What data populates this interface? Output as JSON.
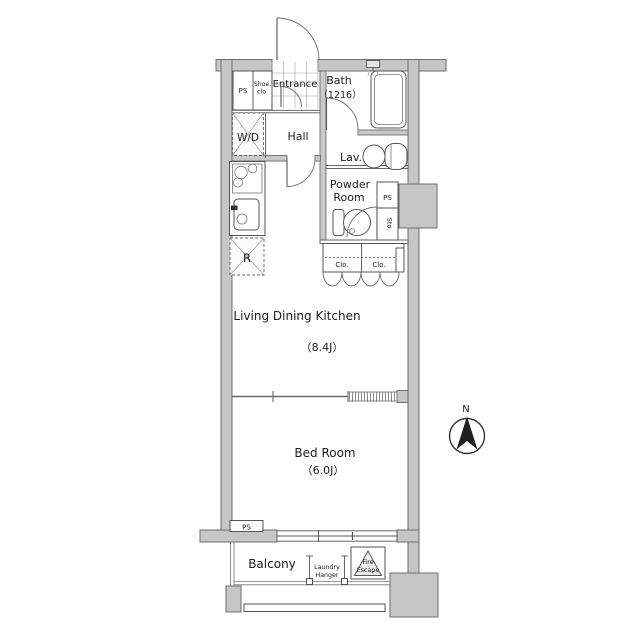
{
  "document_type": "apartment-floor-plan",
  "colors": {
    "background": "#ffffff",
    "wall_fill": "#c6c6c6",
    "wall_outline": "#6e6e6e",
    "line": "#555555",
    "text": "#1c1c1c"
  },
  "compass": {
    "north_label": "N"
  },
  "rooms": {
    "entrance": {
      "label": "Entrance"
    },
    "bath": {
      "label": "Bath",
      "size": "（1216）"
    },
    "shoe_closet": {
      "line1": "Shoe.",
      "line2": "clo."
    },
    "ps_top": {
      "label": "PS"
    },
    "wd": {
      "label": "W/D"
    },
    "hall": {
      "label": "Hall"
    },
    "lav": {
      "label": "Lav."
    },
    "powder_room": {
      "line1": "Powder",
      "line2": "Room"
    },
    "ps_right": {
      "label": "PS"
    },
    "storage": {
      "label": "Sto."
    },
    "refrigerator": {
      "label": "R"
    },
    "closet_left": {
      "label": "Clo."
    },
    "closet_right": {
      "label": "Clo."
    },
    "ldk": {
      "label": "Living Dining Kitchen",
      "size": "（8.4J）"
    },
    "bedroom": {
      "label": "Bed Room",
      "size": "（6.0J）"
    },
    "ps_bottom": {
      "label": "PS"
    },
    "balcony": {
      "label": "Balcony"
    },
    "laundry_hanger": {
      "line1": "Laundry",
      "line2": "Hanger"
    },
    "fire_escape": {
      "line1": "Fire",
      "line2": "Escape"
    }
  }
}
